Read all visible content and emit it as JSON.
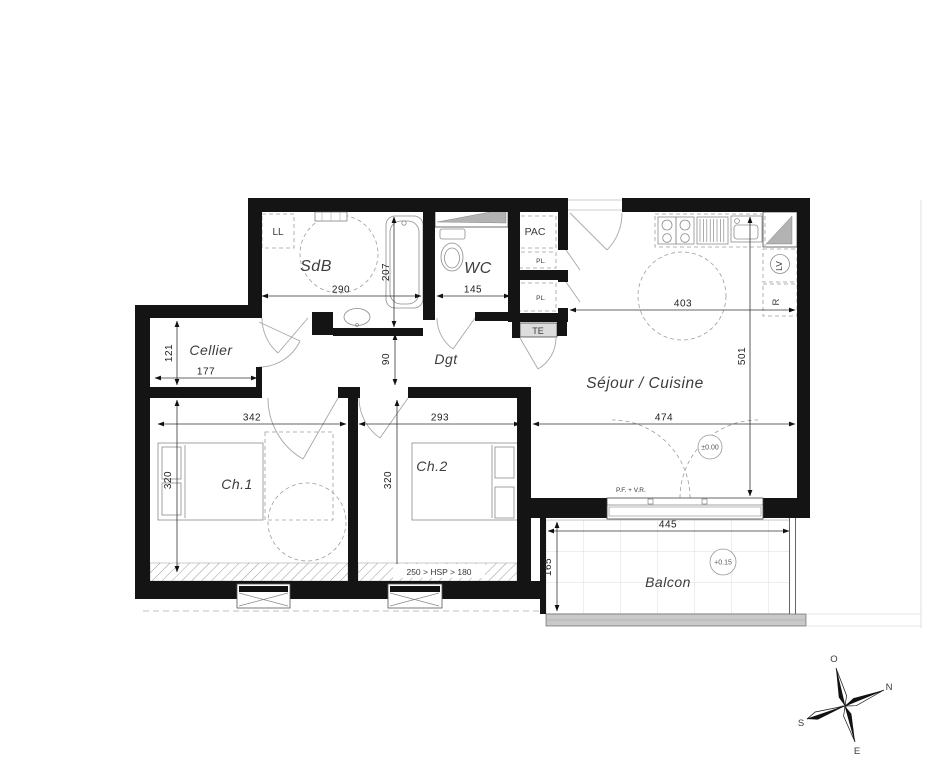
{
  "plan": {
    "title_hint": "apartment floor plan",
    "rooms": {
      "sdb": "SdB",
      "wc": "WC",
      "dgt": "Dgt",
      "cellier": "Cellier",
      "sejour": "Séjour / Cuisine",
      "ch1": "Ch.1",
      "ch2": "Ch.2",
      "balcon": "Balcon"
    },
    "equipment": {
      "ll": "LL",
      "pac": "PAC",
      "pl_upper": "PL.",
      "pl_lower": "PL.",
      "te": "TE",
      "lv": "LV",
      "fridge": "R"
    },
    "dimensions": {
      "sdb_width": "290",
      "bath_length": "207",
      "wc_width": "145",
      "kitchen_width": "403",
      "sejour_depth": "501",
      "cellier_depth": "121",
      "cellier_width": "177",
      "dgt_width": "90",
      "ch1_width": "342",
      "ch2_width": "293",
      "sejour_width": "474",
      "ch1_depth": "320",
      "ch2_depth": "320",
      "balcon_width": "445",
      "balcon_depth": "165"
    },
    "levels": {
      "ground": "±0.00",
      "balcony": "+0.15"
    },
    "notes": {
      "ceiling_height": "250 > HSP > 180",
      "window_type": "P.F. + V.R."
    },
    "compass": {
      "west": "O",
      "north": "N",
      "south": "S",
      "east": "E"
    },
    "colors": {
      "wall": "#141414",
      "duct_fill": "#b3b3b3",
      "te_fill": "#dcdcdc",
      "railing_fill": "#c9c9c9"
    }
  }
}
